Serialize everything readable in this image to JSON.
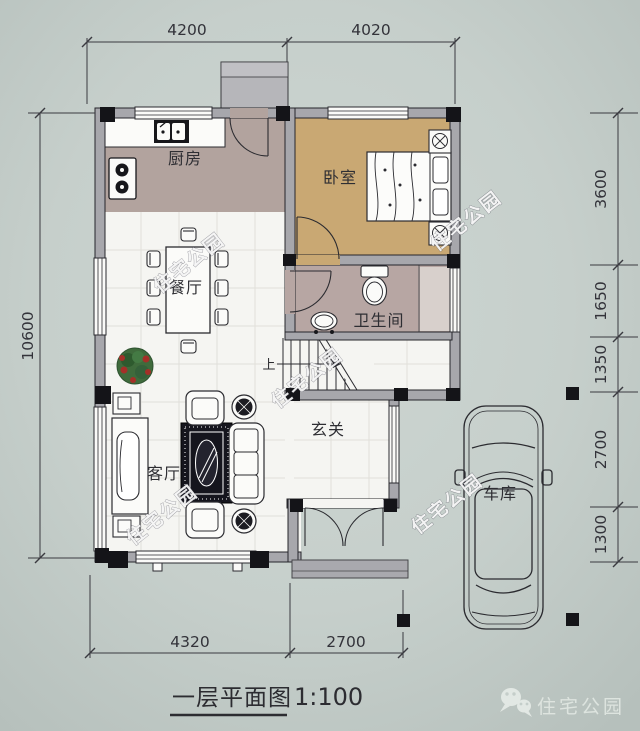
{
  "plan": {
    "rooms": {
      "kitchen": {
        "label": "厨房"
      },
      "bedroom": {
        "label": "卧室"
      },
      "bathroom": {
        "label": "卫生间"
      },
      "dining": {
        "label": "餐厅"
      },
      "living": {
        "label": "客厅"
      },
      "entry": {
        "label": "玄关"
      },
      "garage": {
        "label": "车库"
      }
    },
    "stairs": {
      "up_label": "上"
    }
  },
  "dimensions": {
    "top": [
      "4200",
      "4020"
    ],
    "left": [
      "10600"
    ],
    "right": [
      "3600",
      "1650",
      "1350",
      "2700",
      "1300"
    ],
    "bottom": [
      "4320",
      "2700"
    ]
  },
  "title": {
    "text": "一层平面图",
    "scale": "1:100"
  },
  "watermark": {
    "text": "住宅公园"
  },
  "logo": {
    "text": "住宅公园"
  },
  "colors": {
    "background": "#c6cfcb",
    "wall_fill": "#a7a7ac",
    "kitchen_floor": "#b2a39e",
    "bedroom_floor": "#c9a873",
    "bathroom_floor": "#b7a6a3",
    "floor_white": "#f5f5f2",
    "line": "#2b2b30"
  }
}
